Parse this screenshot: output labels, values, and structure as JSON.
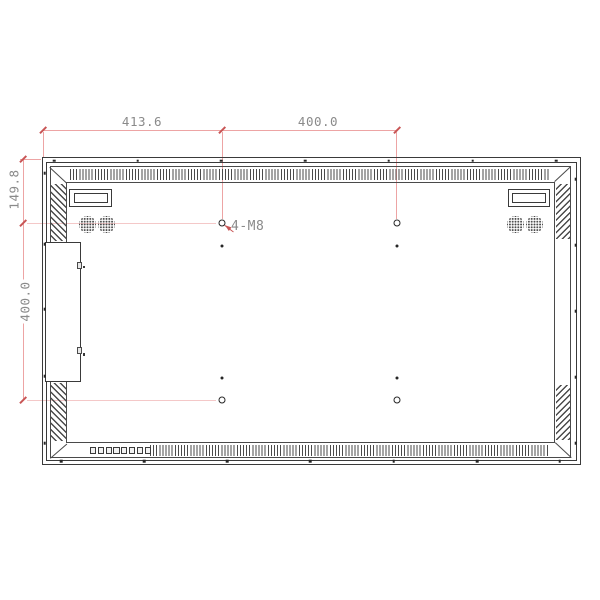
{
  "drawing": {
    "dimensions": {
      "top_width_left": "413.6",
      "top_width_right": "400.0",
      "left_height_upper": "149.8",
      "left_height_lower": "400.0"
    },
    "labels": {
      "vesa_holes": "4-M8"
    },
    "controls": {
      "button_count": 8
    },
    "colors": {
      "line": "#3a3a3a",
      "dimension_line": "#eda4a4",
      "dimension_tick": "#c85555",
      "dimension_text": "#8a8a8a"
    }
  }
}
